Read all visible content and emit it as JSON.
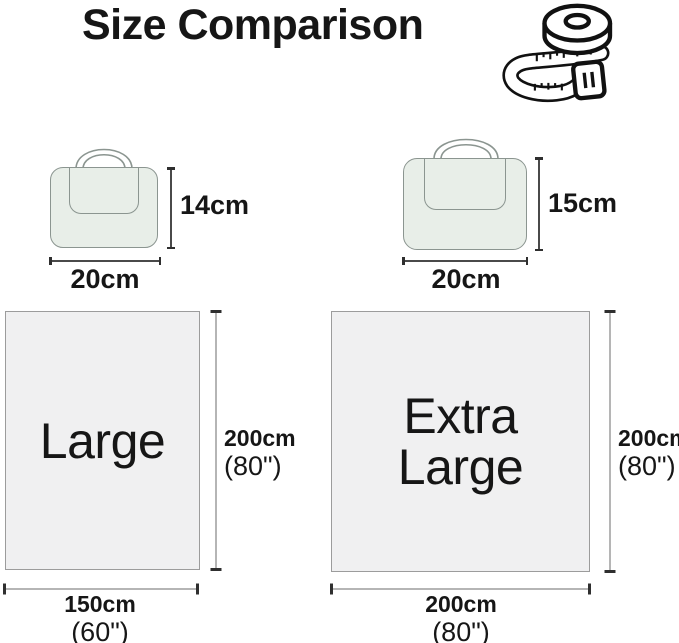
{
  "title": "Size Comparison",
  "bags": {
    "small": {
      "height": "14cm",
      "width": "20cm"
    },
    "large": {
      "height": "15cm",
      "width": "20cm"
    }
  },
  "blankets": {
    "large": {
      "label": "Large",
      "height_cm": "200cm",
      "height_in": "(80\")",
      "width_cm": "150cm",
      "width_in": "(60\")"
    },
    "extra_large": {
      "label": "Extra Large",
      "height_cm": "200cm",
      "height_in": "(80\")",
      "width_cm": "200cm",
      "width_in": "(80\")"
    }
  },
  "colors": {
    "text": "#161616",
    "bag_fill": "#e8eee8",
    "bag_stroke": "#8b9590",
    "blanket_fill": "#f0f0f1",
    "blanket_stroke": "#9c9c9c",
    "dim_line_light": "#b5b5b5",
    "dim_line_dark": "#4a4a4a",
    "dim_bar": "#2f2f2f"
  }
}
